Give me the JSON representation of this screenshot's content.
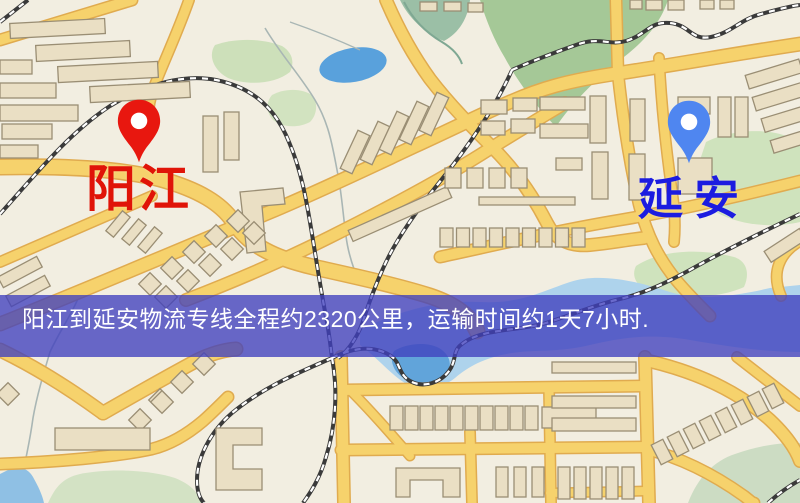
{
  "page": {
    "width": 800,
    "height": 503,
    "kind": "logistics-route-map"
  },
  "banner": {
    "text": "阳江到延安物流专线全程约2320公里，运输时间约1天7小时.",
    "background_color": "#4040be",
    "text_color": "#ffffff"
  },
  "route": {
    "origin": "阳江",
    "destination": "延安",
    "distance_text": "约2320公里",
    "duration_text": "约1天7小时"
  },
  "markers": [
    {
      "id": "origin",
      "label": "阳江",
      "pin_icon": "red-map-pin",
      "pin_color": "#e8170f",
      "label_color": "#e01408",
      "tip_x": 139,
      "tip_y": 165
    },
    {
      "id": "destination",
      "label": "延安",
      "pin_icon": "blue-map-pin",
      "pin_color": "#4f86f0",
      "label_color": "#1c1ce0",
      "tip_x": 689,
      "tip_y": 166
    }
  ],
  "map": {
    "style": "street-map",
    "colors": {
      "background": "#f2eee1",
      "road_fill": "#f6d26c",
      "road_casing": "#e0ab4f",
      "building": "#eadfc4",
      "building_outline": "#9a8e74",
      "green_area": "#cfe3bd",
      "forest": "#a5c897",
      "water": "#aed3ec",
      "pond": "#59a1dc",
      "railway": "#3a3a3a",
      "stream": "#a9b6b4"
    }
  }
}
